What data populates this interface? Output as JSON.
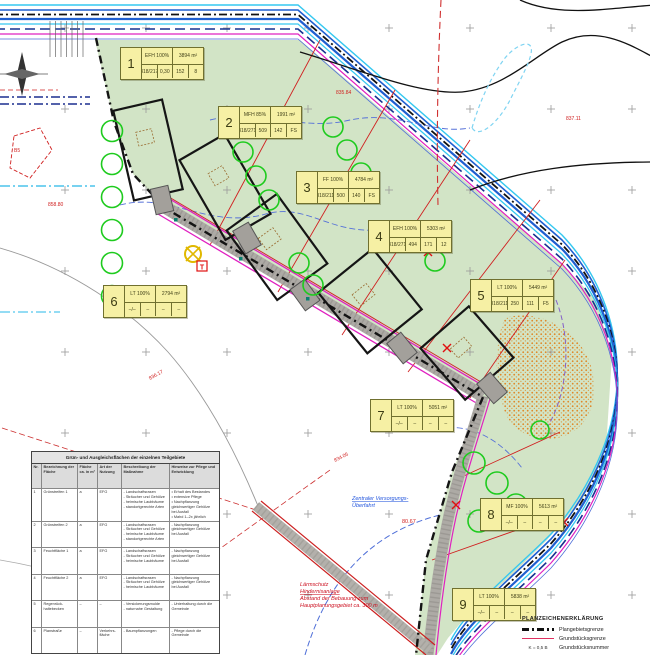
{
  "colors": {
    "site_green": "#d2e4c6",
    "label_yellow": "#f6f0a4",
    "road_gray": "#adaaa5",
    "boundary_black": "#141414",
    "stream_blue": "#1f5fd0",
    "stream_cyan": "#35c8f0",
    "parcel_line_red": "#d02020",
    "magenta": "#e020c0",
    "tree_green": "#1ecb1e",
    "infiltration_orange": "#e08828"
  },
  "parcels": [
    {
      "num": "1",
      "use": "EFH 100%",
      "area": "3894 m²",
      "cells": [
        "318/217",
        "0,30",
        "152",
        "8"
      ]
    },
    {
      "num": "2",
      "use": "MFH 85%",
      "area": "1991 m²",
      "cells": [
        "318/271",
        "509",
        "142",
        "FS"
      ]
    },
    {
      "num": "3",
      "use": "FF 100%",
      "area": "4784 m²",
      "cells": [
        "318/211",
        "500",
        "140",
        "FS"
      ]
    },
    {
      "num": "4",
      "use": "EFH 100%",
      "area": "5303 m²",
      "cells": [
        "318/271",
        "494",
        "171",
        "12"
      ]
    },
    {
      "num": "5",
      "use": "LT 100%",
      "area": "5449 m²",
      "cells": [
        "318/211",
        "250",
        "111",
        "F5"
      ]
    },
    {
      "num": "6",
      "use": "LT 100%",
      "area": "2794 m²",
      "cells": [
        "–/–",
        "–",
        "–",
        "–"
      ]
    },
    {
      "num": "7",
      "use": "LT 100%",
      "area": "5051 m²",
      "cells": [
        "–/–",
        "–",
        "–",
        "–"
      ]
    },
    {
      "num": "8",
      "use": "MF 100%",
      "area": "5613 m²",
      "cells": [
        "–/–",
        "–",
        "–",
        "–"
      ]
    },
    {
      "num": "9",
      "use": "LT 100%",
      "area": "5838 m²",
      "cells": [
        "–/–",
        "–",
        "–",
        "–"
      ]
    }
  ],
  "table": {
    "title": "Grün- und Ausgleichsflächen der einzelnen Teilgebiete",
    "headers": [
      "Nr.",
      "Bezeichnung der Fläche",
      "Fläche ca. in m²",
      "Art der Nutzung",
      "Beschreibung der Maßnahme",
      "Hinweise zur Pflege und Entwicklung"
    ],
    "rows": [
      {
        "nr": "1",
        "name": "Grünstreifen 1",
        "size": "a",
        "type": "EFG",
        "desc": [
          "- Landschaftsrasen",
          "- Sträucher und Gehölze",
          "- heimische Laubbäume",
          "- standortgerechte Arten"
        ],
        "care": [
          "• Erhalt des Bestandes",
          "• extensive Pflege",
          "• Nachpflanzung gleichwertiger Gehölze bei Ausfall",
          "• Mahd 1–2x jährlich"
        ]
      },
      {
        "nr": "2",
        "name": "Grünstreifen 2",
        "size": "a",
        "type": "EFG",
        "desc": [
          "- Landschaftsrasen",
          "- Sträucher und Gehölze",
          "- heimische Laubbäume",
          "- standortgerechte Arten"
        ],
        "care": [
          "- Nachpflanzung gleichwertiger Gehölze bei Ausfall"
        ]
      },
      {
        "nr": "3",
        "name": "Feuchtfläche 1",
        "size": "a",
        "type": "EFG",
        "desc": [
          "- Landschaftsrasen",
          "- Sträucher und Gehölze",
          "- heimische Laubbäume"
        ],
        "care": [
          "- Nachpflanzung gleichwertiger Gehölze bei Ausfall"
        ]
      },
      {
        "nr": "4",
        "name": "Feuchtfläche 2",
        "size": "a",
        "type": "EFG",
        "desc": [
          "- Landschaftsrasen",
          "- Sträucher und Gehölze",
          "- heimische Laubbäume"
        ],
        "care": [
          "- Nachpflanzung gleichwertiger Gehölze bei Ausfall"
        ]
      },
      {
        "nr": "5",
        "name": "Regenrück- haltebecken",
        "size": "–",
        "type": "–",
        "desc": [
          "- Versickerungsmulde",
          "- naturnahe Gestaltung"
        ],
        "care": [
          "- Unterhaltung durch die Gemeinde"
        ]
      },
      {
        "nr": "6",
        "name": "Planstraße",
        "size": "–",
        "type": "Verkehrs- fläche",
        "desc": [
          "- Baumpflanzungen"
        ],
        "care": [
          "- Pflege durch die Gemeinde"
        ]
      }
    ]
  },
  "legend": {
    "heading": "PLANZEICHENERKLÄRUNG",
    "items": [
      {
        "label": "Plangebietsgrenze"
      },
      {
        "label": "Grundstücksgrenze"
      },
      {
        "symbol": "K = 0,5 B",
        "label": "Grundstücksnummer"
      }
    ]
  },
  "annotations": {
    "blue_line1": "Zentraler Versorgungs-",
    "blue_line2": "Überfahrt",
    "elevation": "80.67",
    "red_note": [
      "Lärmschutz",
      "Hindernisanlage",
      "Abstand der Bebauung zum",
      "Hauptplanungsgebiet ca. 300 m"
    ]
  },
  "map_labels": [
    {
      "text": "858.80"
    },
    {
      "text": "835.84"
    },
    {
      "text": "837.11"
    },
    {
      "text": "836.17"
    },
    {
      "text": "834.05"
    },
    {
      "text": "B5"
    }
  ],
  "symbols": {
    "transformer_label": "T"
  }
}
